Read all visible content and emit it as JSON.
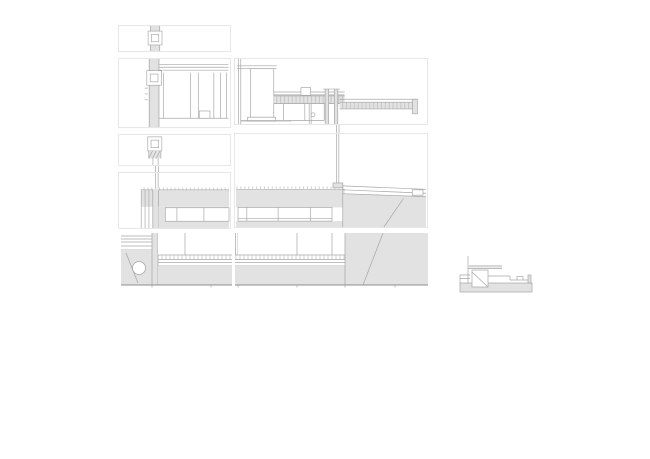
{
  "sheet": {
    "kind": "construction-detail-drawing",
    "background": "#ffffff"
  },
  "colors": {
    "background": "#ffffff",
    "panel_border": "#e7e7e7",
    "line": "#a6a6a6",
    "line_dark": "#8e8e8e",
    "fill_light": "#e2e2e2",
    "fill_medium": "#d8d8d8"
  },
  "panels": [
    {
      "id": "A1",
      "name": "mullion head detail"
    },
    {
      "id": "A2",
      "name": "mullion and roof edge section"
    },
    {
      "id": "B2",
      "name": "roof and terrace junction section"
    },
    {
      "id": "A3",
      "name": "mullion transom detail"
    },
    {
      "id": "A4",
      "name": "clerestory and roof slab section left"
    },
    {
      "id": "B3",
      "name": "clerestory slab and terrace section"
    },
    {
      "id": "C1",
      "name": "basement window and retaining wall section"
    },
    {
      "id": "C2",
      "name": "basement window and ramp section"
    },
    {
      "id": "D",
      "name": "threshold step mini section"
    }
  ]
}
